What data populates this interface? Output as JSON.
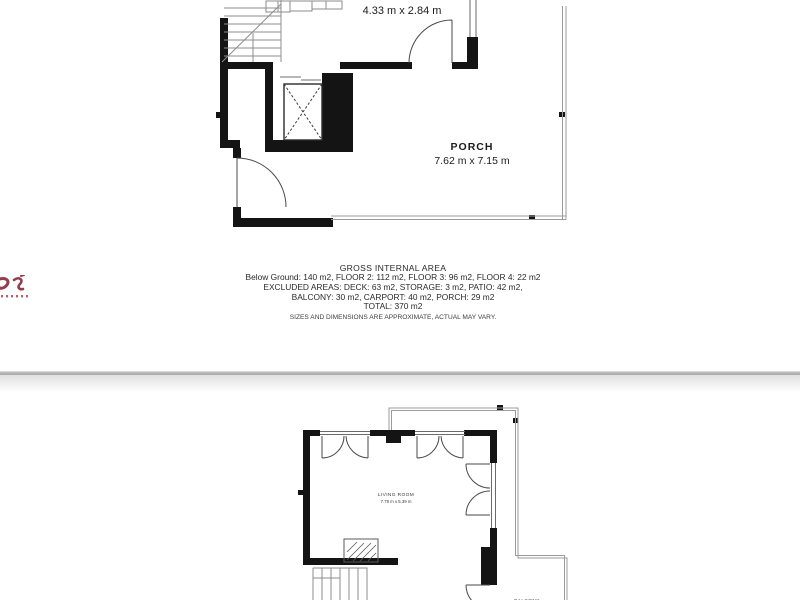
{
  "upper_floorplan": {
    "dimension_label": "4.33 m x 2.84 m",
    "porch": {
      "label": "PORCH",
      "dimensions": "7.62 m x 7.15 m"
    }
  },
  "area_summary": {
    "title": "GROSS INTERNAL AREA",
    "lines": [
      "Below Ground: 140 m2, FLOOR 2: 112 m2, FLOOR 3: 96 m2, FLOOR 4: 22 m2",
      "EXCLUDED AREAS: DECK: 63 m2, STORAGE: 3 m2, PATIO: 42 m2,",
      "BALCONY: 30 m2, CARPORT: 40 m2, PORCH: 29 m2",
      "TOTAL: 370 m2"
    ],
    "disclaimer": "SIZES AND DIMENSIONS ARE APPROXIMATE, ACTUAL MAY VARY."
  },
  "lower_floorplan": {
    "living_room": {
      "label": "LIVING ROOM",
      "dimensions": "7.79 m x 5.39 m"
    },
    "balcony_label": "BALCONY"
  },
  "colors": {
    "wall": "#141414",
    "thin_line": "#9b9b9b",
    "door_line": "#4a4a4a",
    "logo_accent": "#943c4d",
    "text": "#2a2a2a"
  }
}
